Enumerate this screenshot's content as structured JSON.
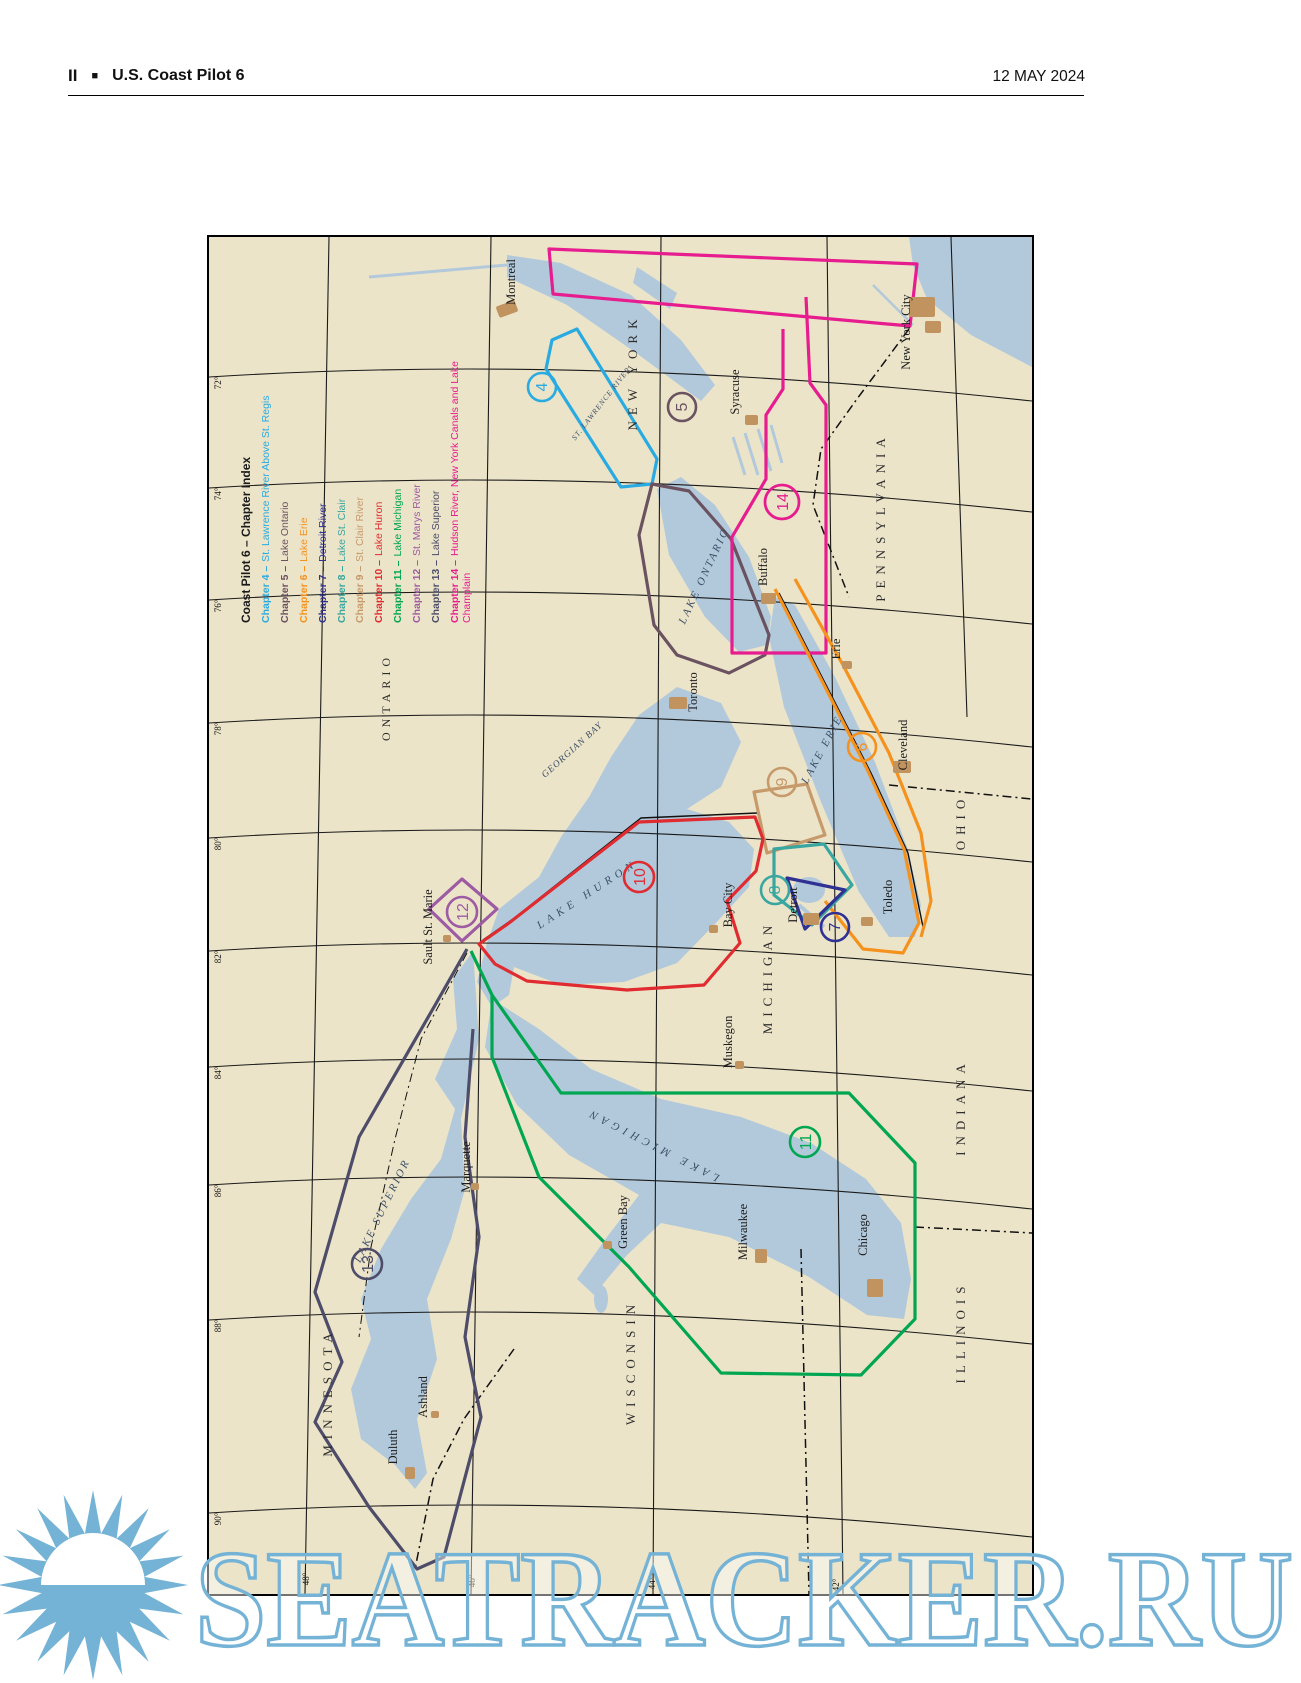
{
  "header": {
    "page_number": "II",
    "bullet": "■",
    "doc_title": "U.S. Coast Pilot 6",
    "date": "12 MAY 2024"
  },
  "legend": {
    "title": "Coast Pilot 6 – Chapter Index",
    "entries": [
      {
        "prefix": "Chapter 4 –",
        "name": "St. Lawrence River Above St. Regis",
        "color": "#29abe2"
      },
      {
        "prefix": "Chapter 5 –",
        "name": "Lake Ontario",
        "color": "#6a5260"
      },
      {
        "prefix": "Chapter 6 –",
        "name": "Lake Erie",
        "color": "#f5921e"
      },
      {
        "prefix": "Chapter 7 –",
        "name": "Detroit River",
        "color": "#2f3193"
      },
      {
        "prefix": "Chapter 8 –",
        "name": "Lake St. Clair",
        "color": "#3aa6a0"
      },
      {
        "prefix": "Chapter 9 –",
        "name": "St. Clair River",
        "color": "#c79a6b"
      },
      {
        "prefix": "Chapter 10 –",
        "name": "Lake Huron",
        "color": "#e02b30"
      },
      {
        "prefix": "Chapter 11 –",
        "name": "Lake Michigan",
        "color": "#00a651"
      },
      {
        "prefix": "Chapter 12 –",
        "name": "St. Marys River",
        "color": "#9c5ba2"
      },
      {
        "prefix": "Chapter 13 –",
        "name": "Lake Superior",
        "color": "#4d4c69"
      },
      {
        "prefix": "Chapter 14 –",
        "name": "Hudson River, New York Canals and Lake Champlain",
        "color": "#e61c8f"
      }
    ]
  },
  "map": {
    "colors": {
      "land": "#ece4c9",
      "water": "#b2c9db",
      "urban": "#c0935f",
      "graticule": "#1a1a1a",
      "watermark": "#74b3d6"
    },
    "states": [
      "NEW YORK",
      "PENNSYLVANIA",
      "OHIO",
      "MICHIGAN",
      "INDIANA",
      "ILLINOIS",
      "WISCONSIN",
      "MINNESOTA"
    ],
    "provinces": [
      "ONTARIO"
    ],
    "lakes": [
      "LAKE ONTARIO",
      "LAKE ERIE",
      "GEORGIAN BAY",
      "LAKE HURON",
      "LAKE MICHIGAN",
      "LAKE SUPERIOR",
      "ST. LAWRENCE RIVER"
    ],
    "cities": [
      "Montreal",
      "New York City",
      "Syracuse",
      "Buffalo",
      "Erie",
      "Cleveland",
      "Toledo",
      "Detroit",
      "Bay City",
      "Toronto",
      "Muskegon",
      "Milwaukee",
      "Chicago",
      "Green Bay",
      "Marquette",
      "Sault St. Marie",
      "Ashland",
      "Duluth"
    ],
    "markers": [
      "4",
      "5",
      "14",
      "6",
      "9",
      "8",
      "7",
      "10",
      "12",
      "11",
      "13"
    ],
    "longitudes": [
      "72°",
      "74°",
      "76°",
      "78°",
      "80°",
      "82°",
      "84°",
      "86°",
      "88°",
      "90°"
    ],
    "latitudes": [
      "48°",
      "46°",
      "44°",
      "42°"
    ]
  },
  "watermark": {
    "text": "SEATRACKER.RU"
  }
}
